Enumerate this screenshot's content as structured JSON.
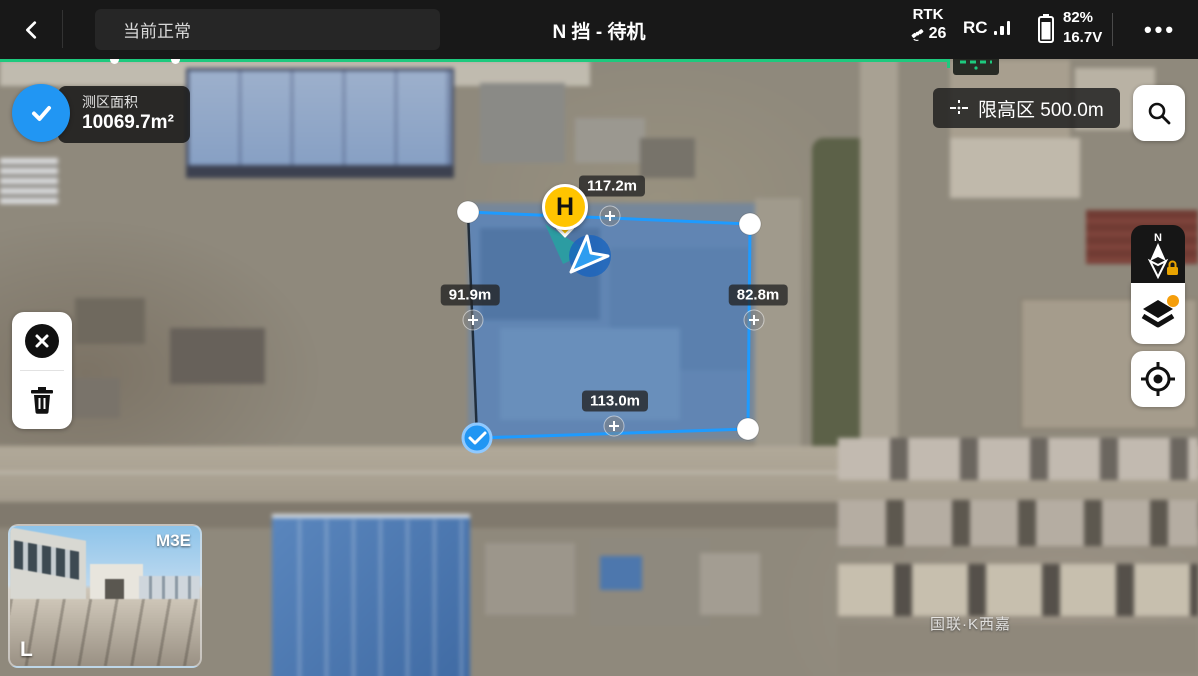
{
  "colors": {
    "accent_green": "#1EC97E",
    "accent_blue": "#2196F3",
    "polygon_blue": "#1E9BFF",
    "marker_yellow": "#FFC400",
    "notification_orange": "#F59E0B"
  },
  "top_bar": {
    "back_icon": "chevron-left",
    "status_text": "当前正常",
    "flight_mode_title": "N 挡 - 待机",
    "rtk_label": "RTK",
    "rtk_satellites": "26",
    "rc_label": "RC",
    "battery_percent": "82%",
    "battery_voltage": "16.7V",
    "more_icon": "•••"
  },
  "area_card": {
    "label": "测区面积",
    "value": "10069.7m²"
  },
  "height_limit_label": "限高区 500.0m",
  "map": {
    "home_marker_label": "H",
    "compass_north_label": "N",
    "edges": [
      {
        "side": "top",
        "length": "117.2m"
      },
      {
        "side": "left",
        "length": "91.9m"
      },
      {
        "side": "right",
        "length": "82.8m"
      },
      {
        "side": "bottom",
        "length": "113.0m"
      }
    ],
    "watermark": "国联·K西嘉"
  },
  "camera_preview": {
    "model_label": "M3E",
    "corner_label": "L"
  }
}
